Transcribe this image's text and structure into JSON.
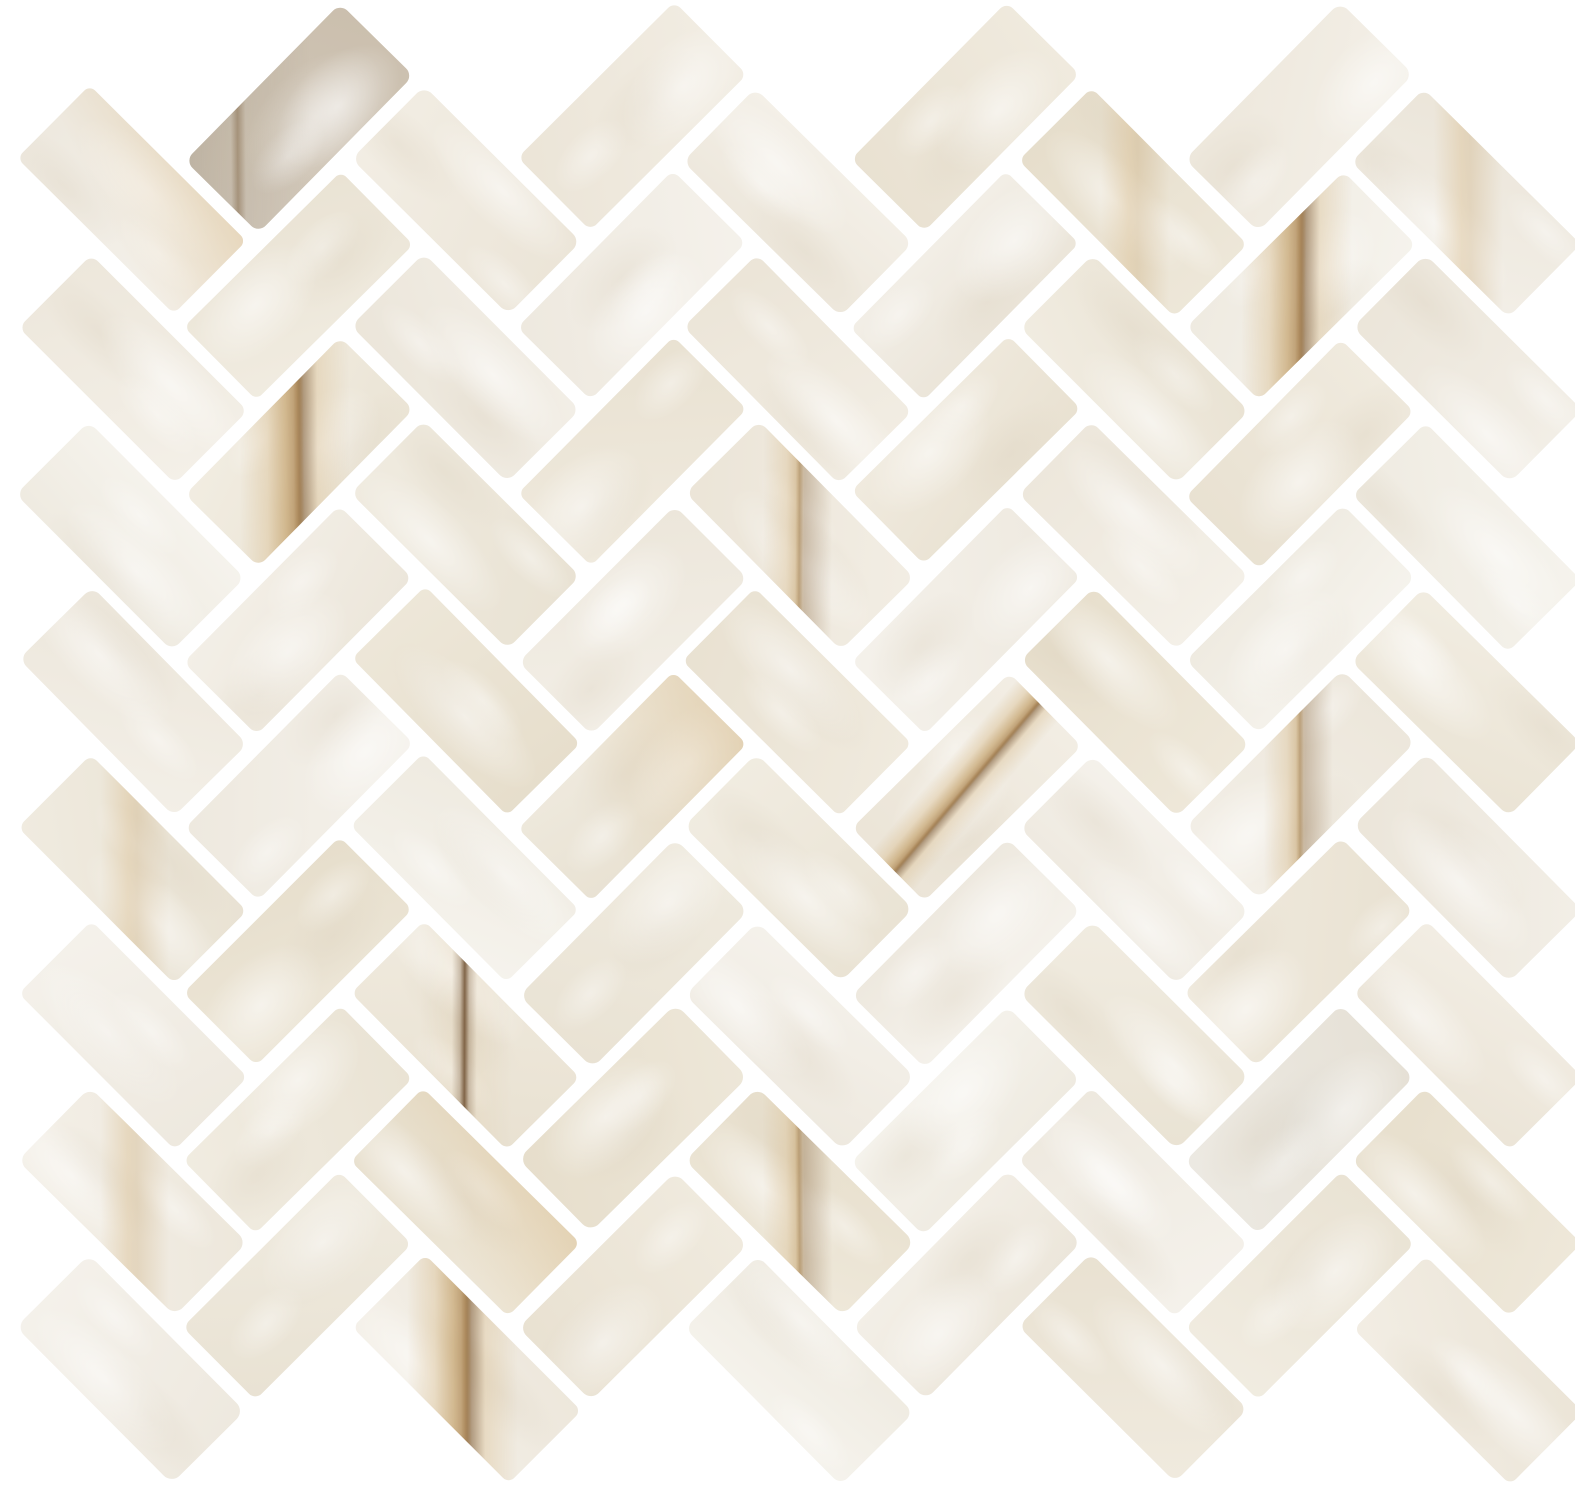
{
  "image": {
    "description": "herringbone-stone-mosaic-sheet",
    "width": 1575,
    "height": 1488,
    "background": "#ffffff"
  },
  "pattern": {
    "type": "herringbone",
    "rotation_deg": 45,
    "tile_long_px": 236,
    "tile_short_px": 118,
    "grout_px": 15,
    "corner_radius_px": 8,
    "seed": 11,
    "bounds": {
      "x_min": -30,
      "x_max": 1640,
      "y_min": -28,
      "y_max": 1530
    },
    "center_x": 757.5,
    "center_y": 744
  },
  "colors": {
    "grout": "#ffffff",
    "palette": [
      "#f1ece2",
      "#efe9dd",
      "#ece5d6",
      "#f3f0e8",
      "#eee8da",
      "#eae2d0",
      "#f0ebe1",
      "#ede7d9",
      "#f2eee6",
      "#e9e1cf",
      "#efeae0",
      "#ece6d8"
    ],
    "mottle_light": "#ffffff",
    "mottle_dark": "#d8cdb9",
    "taupe": "#c8bcab",
    "grey": "#e8e4db",
    "vein_dark": "#85633c",
    "vein_core": "#b08c5c",
    "vein_mid": "#c7a774",
    "vein_light": "#dcc49c",
    "wash": "#d9bd8f",
    "thin_line": "#6e4f30"
  },
  "veins": [
    {
      "x": 368,
      "y": 145,
      "kind": "taupe",
      "dir": "vert"
    },
    {
      "x": 60,
      "y": 235,
      "kind": "wash",
      "dir": "vert"
    },
    {
      "x": 1145,
      "y": 60,
      "kind": "soft",
      "dir": "vert"
    },
    {
      "x": 1320,
      "y": 295,
      "kind": "strong",
      "dir": "vert"
    },
    {
      "x": 1505,
      "y": 155,
      "kind": "soft",
      "dir": "vert"
    },
    {
      "x": 725,
      "y": 495,
      "kind": "medium",
      "dir": "vert"
    },
    {
      "x": 345,
      "y": 520,
      "kind": "strong",
      "dir": "vert"
    },
    {
      "x": 575,
      "y": 820,
      "kind": "wash",
      "dir": "vert"
    },
    {
      "x": 880,
      "y": 820,
      "kind": "strong",
      "dir": "axis"
    },
    {
      "x": 180,
      "y": 880,
      "kind": "soft",
      "dir": "vert"
    },
    {
      "x": 420,
      "y": 975,
      "kind": "thin",
      "dir": "vert"
    },
    {
      "x": 1310,
      "y": 790,
      "kind": "medium",
      "dir": "vert"
    },
    {
      "x": 490,
      "y": 1290,
      "kind": "strong",
      "dir": "vert"
    },
    {
      "x": 560,
      "y": 1185,
      "kind": "wash",
      "dir": "vert"
    },
    {
      "x": 780,
      "y": 1175,
      "kind": "medium",
      "dir": "vert"
    },
    {
      "x": 150,
      "y": 1120,
      "kind": "soft",
      "dir": "vert"
    },
    {
      "x": 1310,
      "y": 1190,
      "kind": "grey",
      "dir": "vert"
    }
  ]
}
